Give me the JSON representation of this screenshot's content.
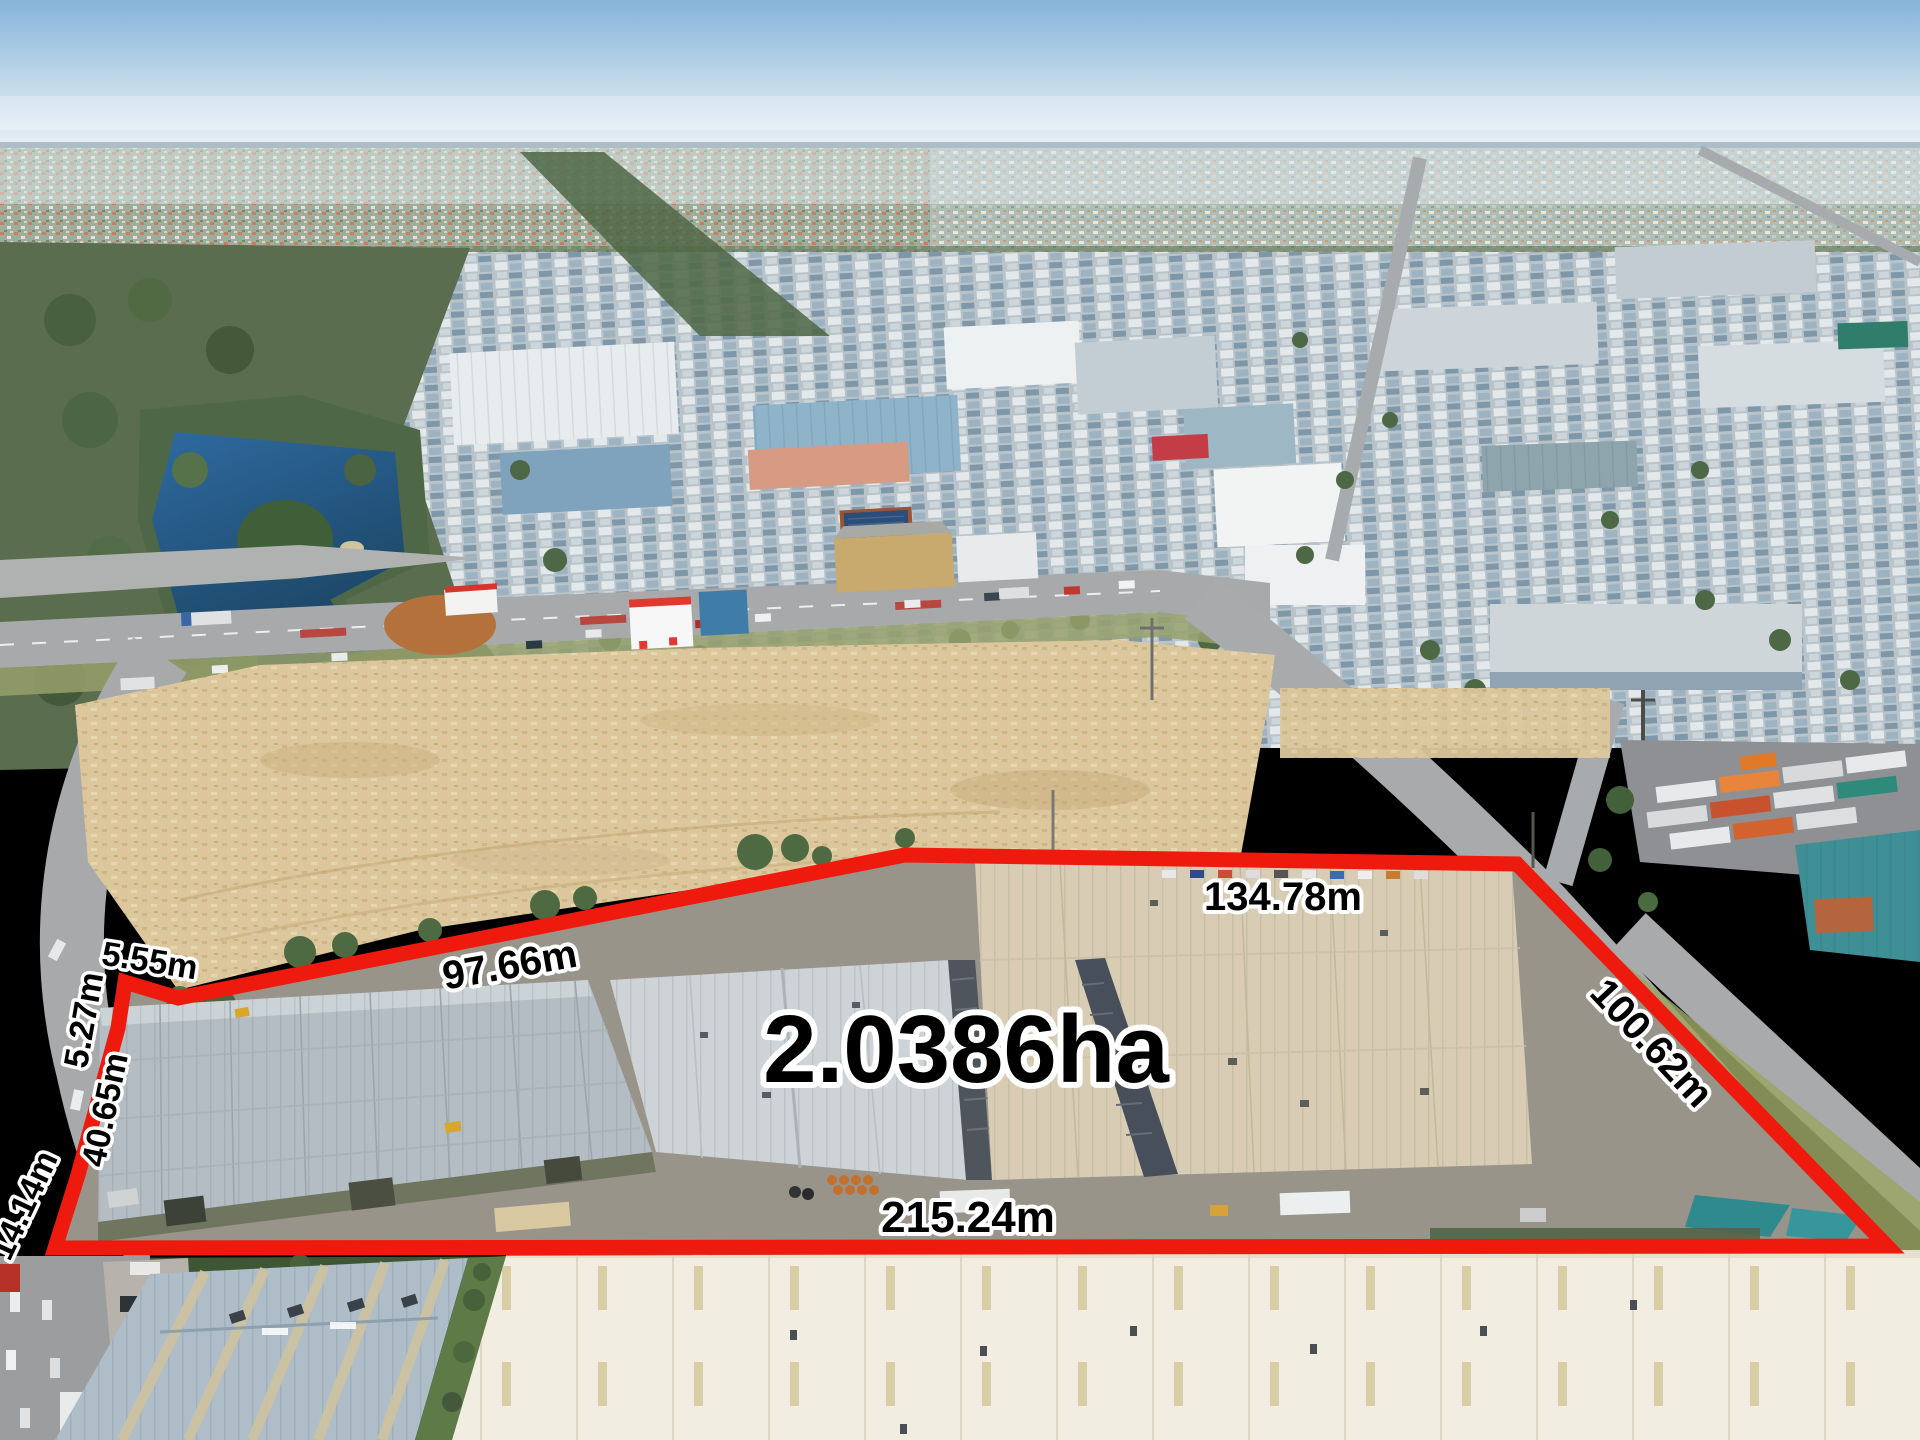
{
  "annotations": {
    "area": "2.0386ha",
    "measurements": {
      "north_small_segment": "5.55m",
      "west_segment_upper": "5.27m",
      "west_segment_mid": "40.65m",
      "west_segment_lower": "14.14m",
      "northwest_edge": "97.66m",
      "north_edge": "134.78m",
      "east_edge": "100.62m",
      "south_edge": "215.24m"
    },
    "colors": {
      "boundary": "#ee1a0e",
      "label_text": "#000000",
      "label_outline": "#ffffff"
    }
  }
}
